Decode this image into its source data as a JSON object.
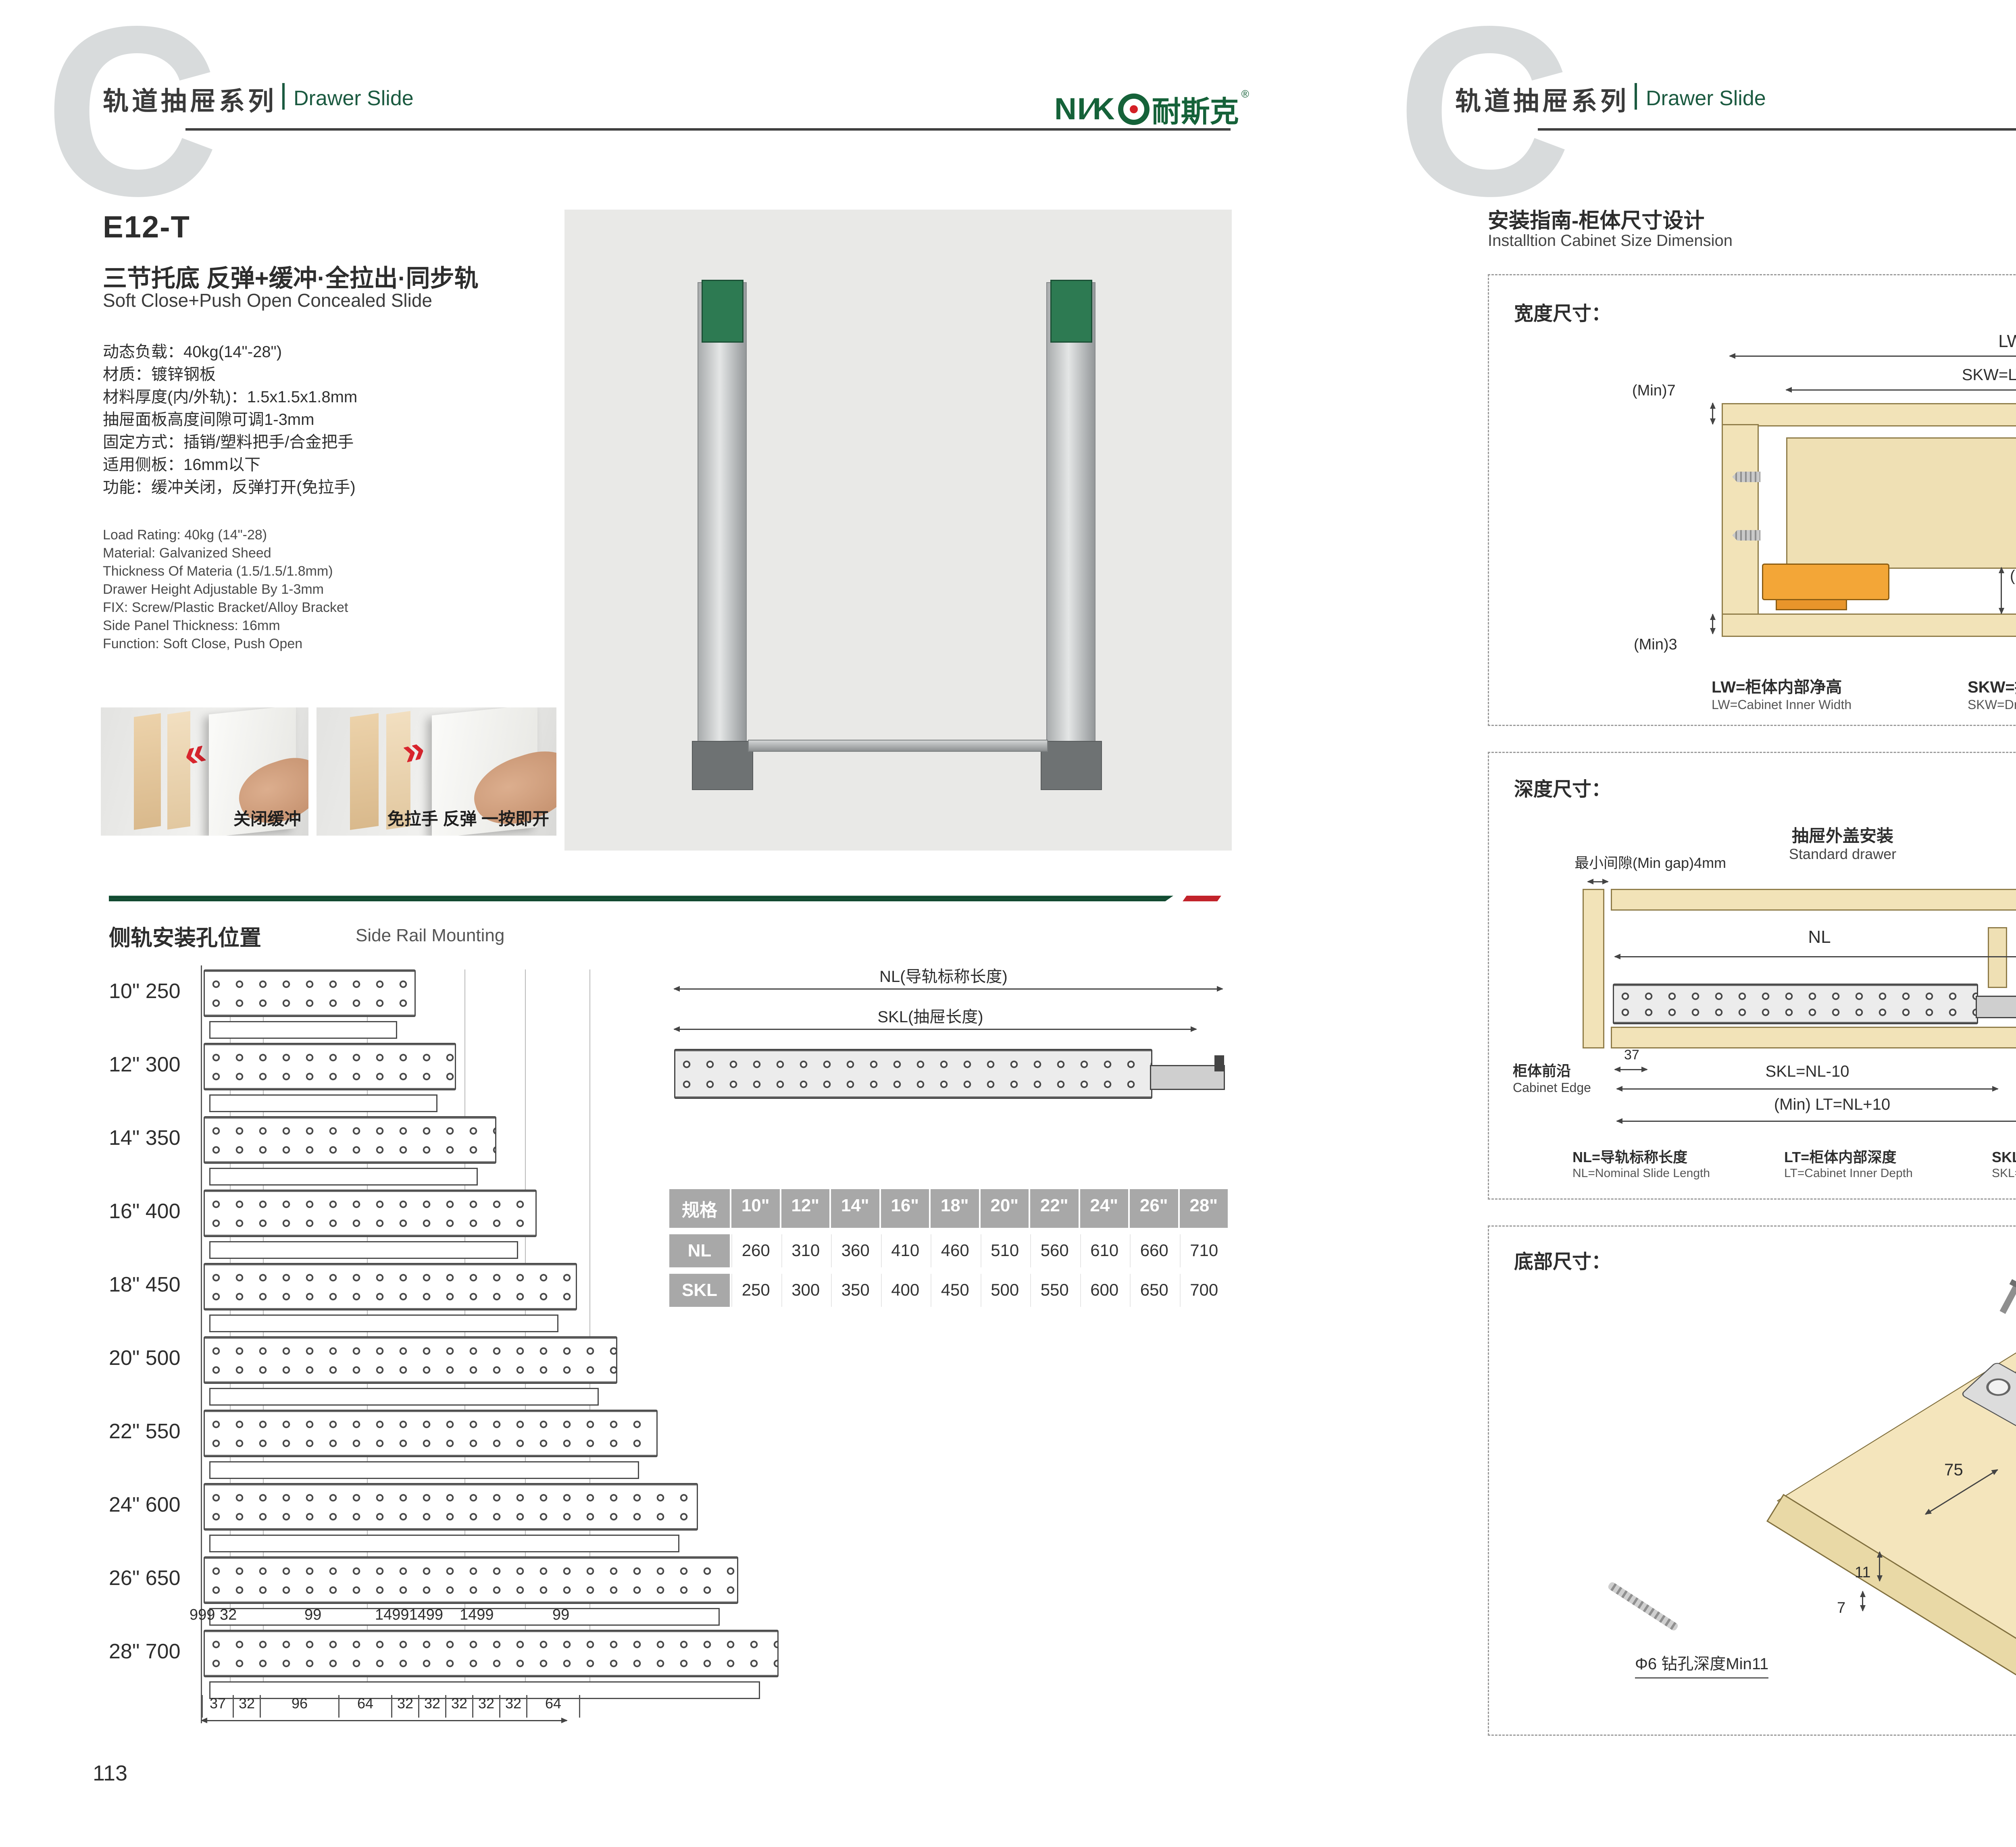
{
  "brand": {
    "latin": "NI∕K",
    "cn": "耐斯克",
    "reg": "®"
  },
  "header": {
    "series_cn": "轨道抽屉系列",
    "series_en": "Drawer Slide"
  },
  "colors": {
    "green": "#1b5a40",
    "red": "#c2232b",
    "logo_green": "#156239",
    "wood": "#f2e3b8",
    "orange": "#f3a637"
  },
  "left_page": {
    "page_number": "113",
    "product": {
      "model": "E12-T",
      "title_cn": "三节托底 反弹+缓冲·全拉出·同步轨",
      "title_en": "Soft Close+Push Open Concealed Slide",
      "specs_cn": [
        "动态负载：40kg(14\"-28\")",
        "材质：镀锌钢板",
        "材料厚度(内/外轨)：1.5x1.5x1.8mm",
        "抽屉面板高度间隙可调1-3mm",
        "固定方式：插销/塑料把手/合金把手",
        "适用侧板：16mm以下",
        "功能：缓冲关闭，反弹打开(免拉手)"
      ],
      "specs_en": [
        "Load Rating: 40kg (14\"-28)",
        "Material: Galvanized Sheed",
        "Thickness Of Materia (1.5/1.5/1.8mm)",
        "Drawer Height Adjustable By 1-3mm",
        "FIX: Screw/Plastic Bracket/Alloy Bracket",
        "Side Panel Thickness: 16mm",
        "Function: Soft Close, Push Open"
      ],
      "photo_captions": [
        "关闭缓冲",
        "免拉手 反弹 一按即开"
      ]
    },
    "side_rail": {
      "title_cn": "侧轨安装孔位置",
      "title_en": "Side Rail Mounting",
      "rows": [
        {
          "inch": "10\"",
          "mm": "250",
          "nl": 260
        },
        {
          "inch": "12\"",
          "mm": "300",
          "nl": 310
        },
        {
          "inch": "14\"",
          "mm": "350",
          "nl": 360
        },
        {
          "inch": "16\"",
          "mm": "400",
          "nl": 410
        },
        {
          "inch": "18\"",
          "mm": "450",
          "nl": 460
        },
        {
          "inch": "20\"",
          "mm": "500",
          "nl": 510
        },
        {
          "inch": "22\"",
          "mm": "550",
          "nl": 560
        },
        {
          "inch": "24\"",
          "mm": "600",
          "nl": 610
        },
        {
          "inch": "26\"",
          "mm": "650",
          "nl": 660
        },
        {
          "inch": "28\"",
          "mm": "700",
          "nl": 710
        }
      ],
      "top_dims": [
        "999",
        "32",
        "99",
        "14991499",
        "1499",
        "99"
      ],
      "bottom_dims": [
        "37",
        "32",
        "96",
        "64",
        "32",
        "32",
        "32",
        "32",
        "32",
        "64"
      ],
      "diagram": {
        "nl_label": "NL(导轨标称长度)",
        "skl_label": "SKL(抽屉长度)"
      },
      "table": {
        "header": [
          "规格",
          "10\"",
          "12\"",
          "14\"",
          "16\"",
          "18\"",
          "20\"",
          "22\"",
          "24\"",
          "26\"",
          "28\""
        ],
        "nl_row": {
          "label": "NL",
          "values": [
            "260",
            "310",
            "360",
            "410",
            "460",
            "510",
            "560",
            "610",
            "660",
            "710"
          ]
        },
        "skl_row": {
          "label": "SKL",
          "values": [
            "250",
            "300",
            "350",
            "400",
            "450",
            "500",
            "550",
            "600",
            "650",
            "700"
          ]
        }
      }
    }
  },
  "right_page": {
    "page_number": "114",
    "title_cn": "安装指南-柜体尺寸设计",
    "title_en": "Installtion Cabinet Size Dimension",
    "width_section": {
      "label": "宽度尺寸：",
      "dims": {
        "lw": "LW",
        "skw": "SKW=LW-42",
        "min7": "(Min)7",
        "max16": "(Max)16",
        "v12": "12",
        "v10": "10",
        "v37": "37",
        "min275": "(Min)27.5",
        "min3": "(Min)3",
        "v21": "21"
      },
      "legend": [
        {
          "cn": "LW=柜体内部净高",
          "en": "LW=Cabinet Inner Width"
        },
        {
          "cn": "SKW=抽屉宽度",
          "en": "SKW=Drawer  Width"
        },
        {
          "cn": "最大尺寸",
          "en": "Max"
        },
        {
          "cn": "最小尺寸",
          "en": "Min"
        }
      ]
    },
    "depth_section": {
      "label": "深度尺寸：",
      "min_gap": "最小间隙(Min gap)4mm",
      "standard": {
        "title_cn": "抽屉外盖安装",
        "title_en": "Standard drawer",
        "nl": "NL",
        "d37": "37",
        "skl": "SKL=NL-10",
        "lt": "(Min) LT=NL+10",
        "edge_cn": "柜体前沿",
        "edge_en": "Cabinet Edge"
      },
      "builtin": {
        "title_cn": "抽屉内置安装",
        "title_en": "Built-in drawer",
        "x": "X",
        "nl": "NL",
        "iskl": "ISKL=SKL+X",
        "lt": "(Min) LT=NL+X+10",
        "edge_cn": "柜体前沿",
        "edge_en": "Cabinet Edge"
      },
      "legend": [
        {
          "cn": "NL=导轨标称长度",
          "en": "NL=Nominal Slide Length"
        },
        {
          "cn": "LT=柜体内部深度",
          "en": "LT=Cabinet Inner Depth"
        },
        {
          "cn": "SKL=抽屉长度",
          "en": "SKL=Drawer Length"
        },
        {
          "cn": "ISKL=内抽屉长度",
          "en": "ISKL=Drawer Inner Length"
        },
        {
          "cn": "X=抽屉面板厚度",
          "en": "X=Drawer Panel Thickness"
        }
      ]
    },
    "bottom_section": {
      "label": "底部尺寸：",
      "dims": {
        "d75": "75",
        "d85": "85",
        "d11": "11",
        "d7": "7"
      },
      "drill": "Φ6 钻孔深度Min11",
      "skl_note": "抽屉长度SKL=导轨标称长度NL-10"
    }
  }
}
